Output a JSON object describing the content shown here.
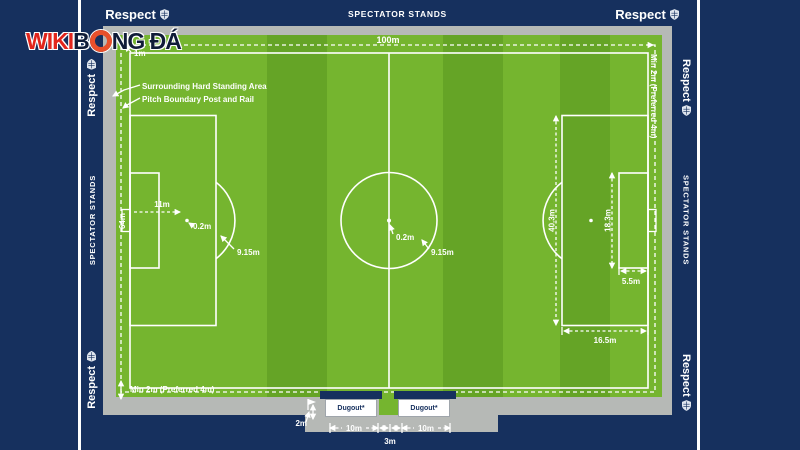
{
  "logo": {
    "wiki": "WIKI",
    "b": "B",
    "ngda": "NG ĐÁ"
  },
  "frame": {
    "respect": "Respect",
    "spectator_stands": "SPECTATOR STANDS"
  },
  "pitch_labels": {
    "length": "100m",
    "width": "64m",
    "rail_gap": "1m",
    "hard_standing": "Surrounding Hard Standing Area",
    "boundary_rail": "Pitch Boundary Post and Rail",
    "min_runoff": "Min 2m (Preferred 4m)",
    "penalty_distance": "11m",
    "spot_size": "0.2m",
    "arc_radius": "9.15m",
    "penalty_area_width": "40.3m",
    "goal_area_width": "18.3m",
    "goal_area_depth": "5.5m",
    "penalty_area_depth": "16.5m"
  },
  "dugout_area": {
    "dugout": "Dugout*",
    "corner_offset": "2m",
    "dugout_distance": "10m",
    "gap": "3m"
  },
  "colors": {
    "navy": "#16305e",
    "grass_light": "#75b52f",
    "grass_dark": "#65a426",
    "hard_standing_gray": "#b6b9b6",
    "line_white": "#ffffff",
    "logo_red": "#e2251c",
    "logo_ring_orange": "#e8502b",
    "logo_dark": "#101c38"
  }
}
